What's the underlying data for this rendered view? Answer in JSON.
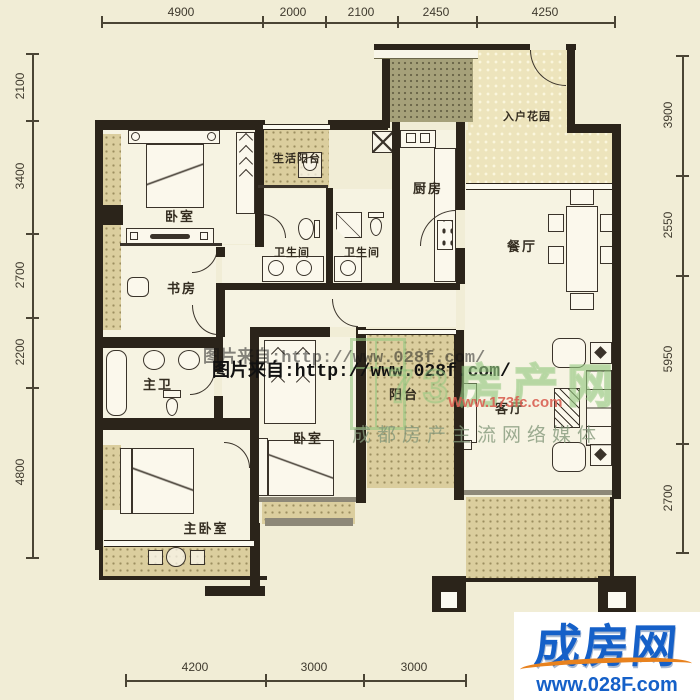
{
  "rooms": {
    "bedroom1": "卧室",
    "study": "书房",
    "master_bath": "主卫",
    "master_bedroom": "主卧室",
    "bedroom2": "卧室",
    "utility_balcony": "生活阳台",
    "bath1": "卫生间",
    "bath2": "卫生间",
    "kitchen": "厨房",
    "entry_garden": "入户花园",
    "dining": "餐厅",
    "living": "客厅",
    "balcony": "阳台"
  },
  "dims": {
    "top": [
      "4900",
      "2000",
      "2100",
      "2450",
      "4250"
    ],
    "left": [
      "2100",
      "3400",
      "2700",
      "2200",
      "4800"
    ],
    "right": [
      "3900",
      "2550",
      "5950",
      "2700"
    ],
    "bottom": [
      "4200",
      "3000",
      "3000"
    ]
  },
  "watermarks": {
    "source_line1": "图片来自:http://www.028f.com/",
    "source_line2": "图片来自:http://www.028f.com/",
    "agency_big": "73房产网",
    "agency_url": "Www.173fc.com",
    "agency_slogan": "成都房产主流网络媒体"
  },
  "logo": {
    "name": "成房网",
    "url": "www.028F.com"
  },
  "colors": {
    "background": "#f1edd6",
    "wall": "#2b241a",
    "balcony_hatch": "#dbce9e",
    "roof_hatch": "#a6a17a",
    "garden_hatch": "#ede4bc",
    "logo_blue": "#1560c8",
    "logo_orange": "#e8821e",
    "watermark_green": "#8cc37d",
    "watermark_red": "#d95f52"
  }
}
